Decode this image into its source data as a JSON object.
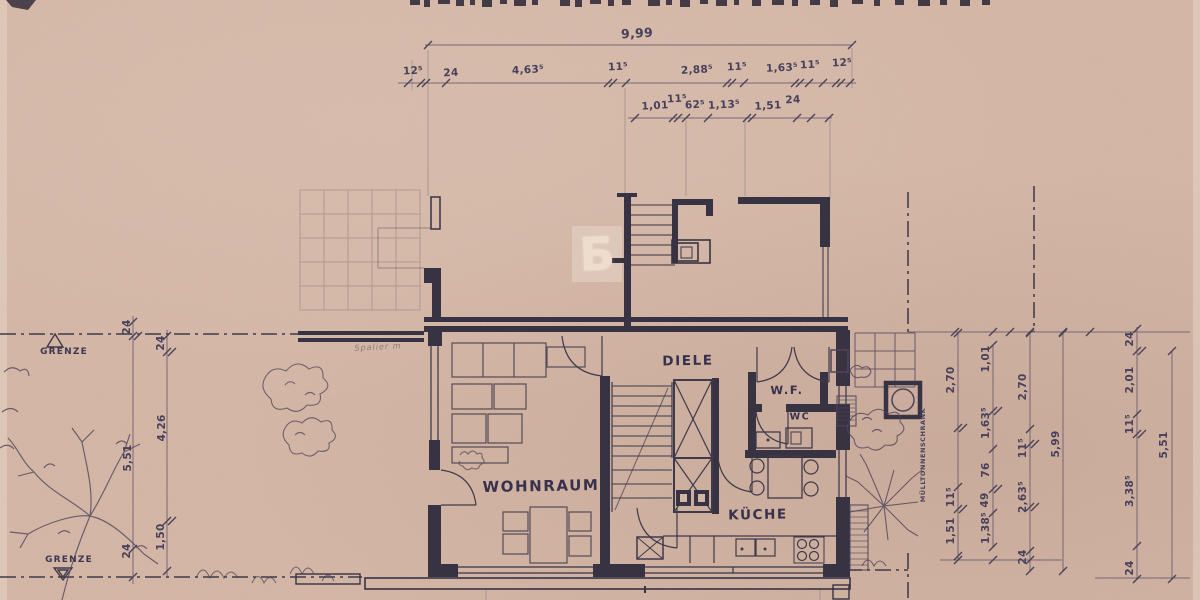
{
  "watermark": "Б",
  "rooms": {
    "wohnraum": "WOHNRAUM",
    "diele": "DIELE",
    "kueche": "KÜCHE",
    "wc": "WC",
    "wf": "W.F."
  },
  "site": {
    "grenze_top": "GRENZE",
    "grenze_bottom": "GRENZE",
    "muelltonnenschrank": "MÜLLTONNENSCHRANK",
    "pencil_note": "Spalier m"
  },
  "dims": {
    "overall": "9,99",
    "top_row1": [
      "12⁵",
      "24",
      "4,63⁵",
      "11⁵",
      "2,88⁵",
      "11⁵",
      "1,63⁵",
      "11⁵",
      "12⁵"
    ],
    "top_row2": [
      "1,01",
      "11⁵",
      "62⁵",
      "1,13⁵",
      "1,51",
      "24"
    ],
    "left_outer": [
      "24",
      "5,51",
      "24"
    ],
    "left_inner": [
      "24",
      "4,26",
      "1,50"
    ],
    "right_col1": [
      "2,70",
      "11⁵",
      "1,51"
    ],
    "right_col2": [
      "1,01",
      "1,63⁵",
      "76",
      "49",
      "1,38⁵"
    ],
    "right_col3": [
      "2,70",
      "11⁵",
      "2,63⁵",
      "24"
    ],
    "right_col4": [
      "5,99"
    ],
    "right_col5": [
      "24",
      "2,01",
      "11⁵",
      "3,38⁵",
      "24"
    ],
    "right_col6": [
      "5,51"
    ]
  },
  "colors": {
    "paper": "#d6b8a8",
    "ink": "#322e40",
    "pencil": "#46405a",
    "watermark": "#eedccd"
  }
}
